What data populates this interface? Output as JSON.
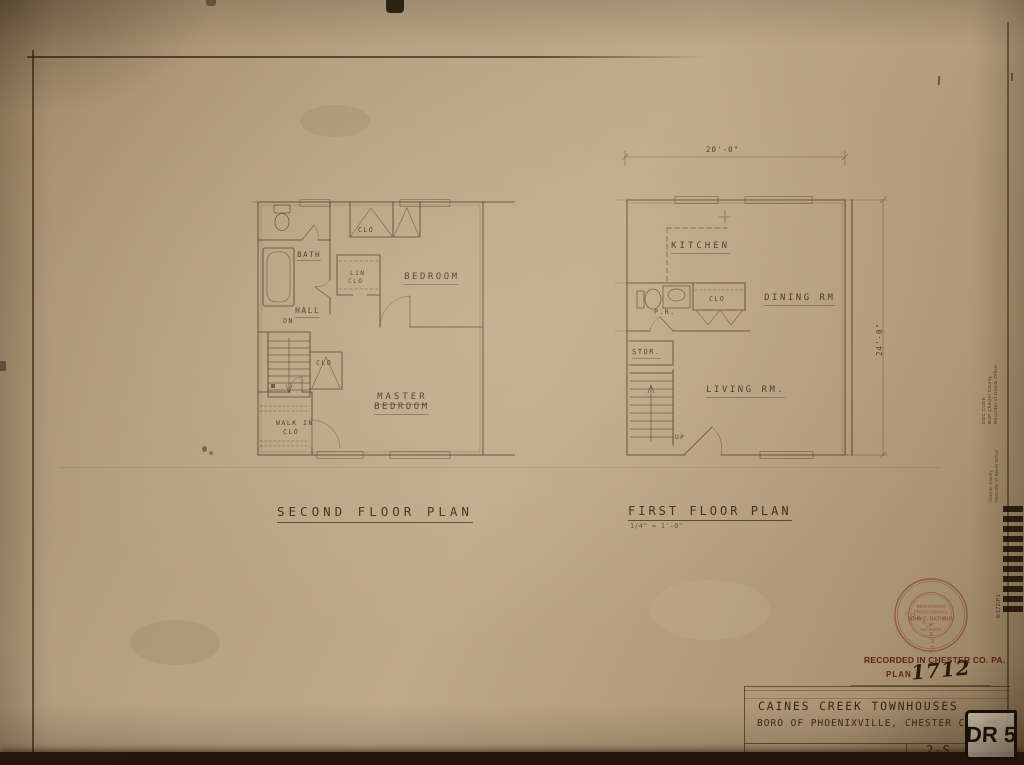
{
  "colors": {
    "paper": "#b7a283",
    "ink": "#4a3322",
    "red_ink": "#5e2115",
    "seal_ink": "#8a4434"
  },
  "plans": {
    "second": {
      "title": "SECOND FLOOR PLAN",
      "labels": {
        "bath": "BATH",
        "clo_top": "CLO",
        "bedroom": "BEDROOM",
        "lin_1": "LIN",
        "lin_2": "CLO",
        "hall": "HALL",
        "dn": "DN",
        "clo_mid": "CLO",
        "master_1": "MASTER",
        "master_2": "BEDROOM",
        "walkin_1": "WALK IN",
        "walkin_2": "CLO"
      }
    },
    "first": {
      "title": "FIRST FLOOR PLAN",
      "scale": "1/4\" = 1'-0\"",
      "dim_width": "20'-0\"",
      "dim_height": "24'-0\"",
      "labels": {
        "kitchen": "KITCHEN",
        "clo": "CLO",
        "dining": "DINING RM",
        "pr": "P.R.",
        "stor": "STOR.",
        "living": "LIVING RM.",
        "up": "UP"
      }
    }
  },
  "seal": {
    "ring": "COMMONWEALTH OF PENNSYLVANIA",
    "line_1": "REGISTERED",
    "line_2": "PROFESSIONAL",
    "name": "JOHN C. RATHBUN",
    "number": "No. 10201"
  },
  "recorded": {
    "line_1": "RECORDED IN CHESTER CO. PA.",
    "plan_label": "PLAN",
    "plan_number": "1712"
  },
  "title_block": {
    "project": "CAINES CREEK TOWNHOUSES",
    "location": "BORO OF PHOENIXVILLE, CHESTER CO. PA",
    "sheet_number": "2-S",
    "stamp": "DR 5"
  },
  "edge": {
    "stamp_1a": "DOC CODE",
    "stamp_1b": "BOP Chester County",
    "stamp_1c": "Recorder of Deeds Office",
    "stamp_2a": "Chester County",
    "stamp_2b": "Recorder of Deeds Office",
    "barcode_caption": "8/172/P1"
  }
}
